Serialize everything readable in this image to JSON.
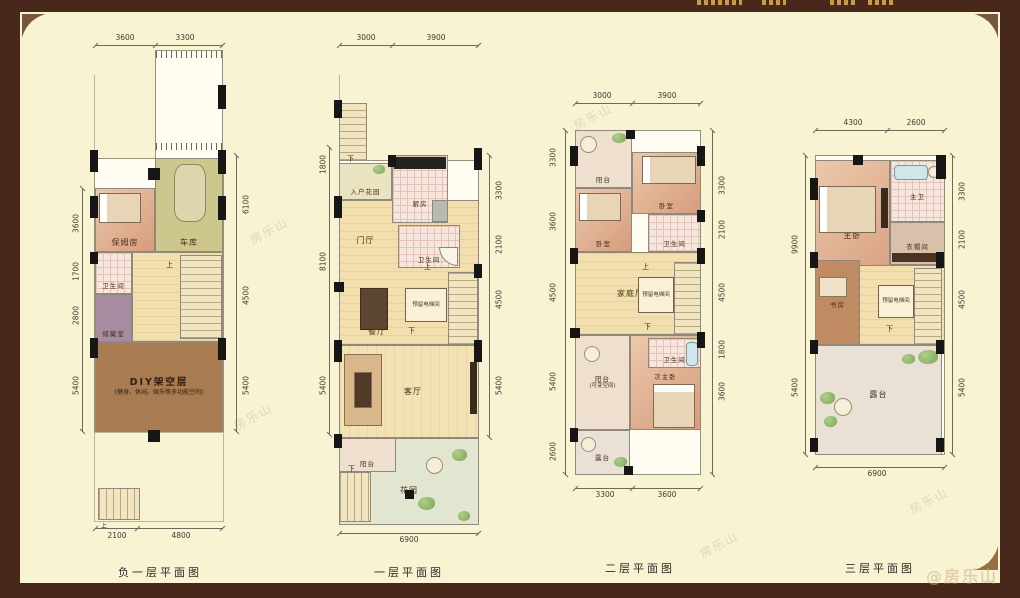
{
  "page": {
    "watermark": "房乐山",
    "credit": "@房乐山"
  },
  "labels": {
    "up": "上",
    "down": "下"
  },
  "plans": [
    {
      "title": "负一层平面图",
      "rooms": {
        "nanny": "保姆房",
        "garage": "车库",
        "bath": "卫生间",
        "storage": "储藏室",
        "diy": "DIY架空层",
        "diy_sub": "(健身、休闲、娱乐等多功能空间)"
      },
      "dims": {
        "top": [
          "3600",
          "3300"
        ],
        "left": [
          "3600",
          "1700",
          "2800",
          "5400"
        ],
        "right": [
          "6100",
          "4500",
          "5400"
        ],
        "bottom": [
          "2100",
          "4800"
        ]
      }
    },
    {
      "title": "一层平面图",
      "rooms": {
        "entry_garden": "入户花园",
        "kitchen": "厨房",
        "foyer": "门厅",
        "bath": "卫生间",
        "dining": "餐厅",
        "elevator": "预留电梯间",
        "living": "客厅",
        "balcony": "阳台",
        "garden": "花园"
      },
      "dims": {
        "top": [
          "3000",
          "3900"
        ],
        "left": [
          "1800",
          "8100",
          "5400"
        ],
        "right": [
          "3300",
          "2100",
          "4500",
          "5400"
        ],
        "bottom": [
          "6900"
        ]
      }
    },
    {
      "title": "二层平面图",
      "rooms": {
        "balcony": "阳台",
        "bedroom1": "卧室",
        "bedroom2": "卧室",
        "bath1": "卫生间",
        "family": "家庭厅",
        "elevator": "预留电梯间",
        "bath2": "卫生间",
        "second_master": "次主卧",
        "balcony2": "阳台",
        "balcony2_sub": "(可变空间)",
        "terrace": "露台"
      },
      "dims": {
        "top": [
          "3000",
          "3900"
        ],
        "left": [
          "3300",
          "3600",
          "4500",
          "5400",
          "2600"
        ],
        "right": [
          "3300",
          "2100",
          "4500",
          "1800",
          "3600"
        ],
        "bottom": [
          "3300",
          "3600"
        ]
      }
    },
    {
      "title": "三层平面图",
      "rooms": {
        "master": "主卧",
        "master_bath": "主卫",
        "closet": "衣帽间",
        "study": "书房",
        "elevator": "预留电梯间",
        "terrace": "露台"
      },
      "dims": {
        "top": [
          "4300",
          "2600"
        ],
        "left": [
          "9900",
          "5400"
        ],
        "right": [
          "3300",
          "2100",
          "4500",
          "5400"
        ],
        "bottom": [
          "6900"
        ]
      }
    }
  ]
}
